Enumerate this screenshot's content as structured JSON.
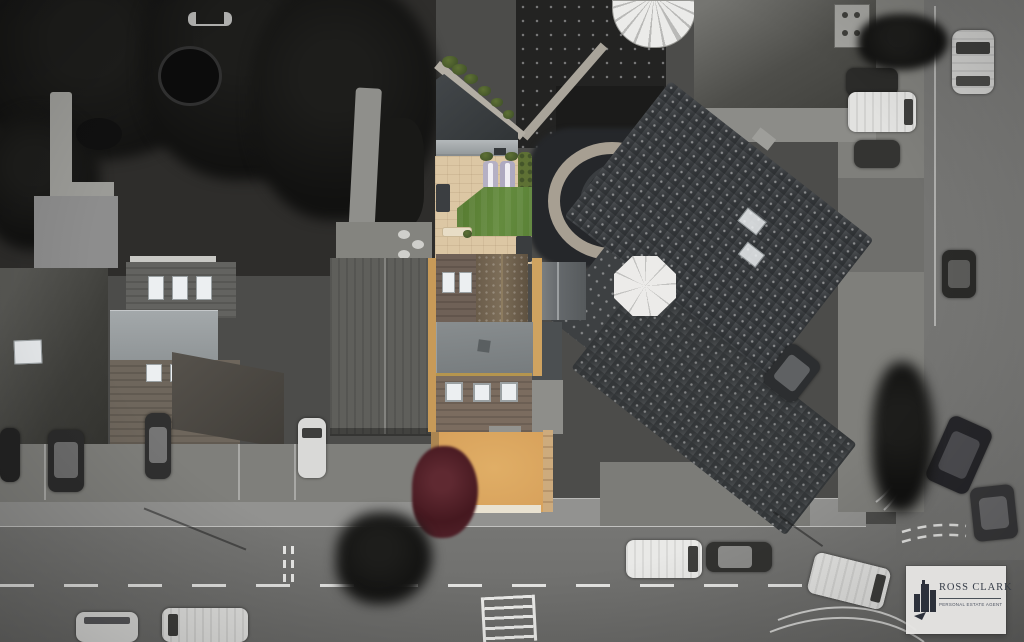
{
  "meta": {
    "kind": "aerial-drone-photograph",
    "style": "selective-colour (greyscale scene, one property in colour)",
    "subject": "residential street seen from above with highlighted property, gardens, roads and vehicles"
  },
  "watermark": {
    "brand": "ROSS CLARK",
    "tagline": "PERSONAL ESTATE AGENT",
    "icon": "buildings-skyline-icon"
  },
  "palette": {
    "lawn-green": "#5c8038",
    "patio-tan": "#dcc7a4",
    "driveway-orange": "#d8a25c",
    "roof-brown": "#7b6c5f",
    "roof-brown-dark": "#6a5c4a",
    "tree-maroon": "#54232c",
    "hedge-olive": "#5e7134",
    "road-gray": "#6f6f6f",
    "sidewalk-gray": "#929290",
    "garden-dark": "#262626",
    "marking-white": "#e3e3e3",
    "logo-card": "#e7e6e4",
    "logo-ink": "#333a46"
  }
}
